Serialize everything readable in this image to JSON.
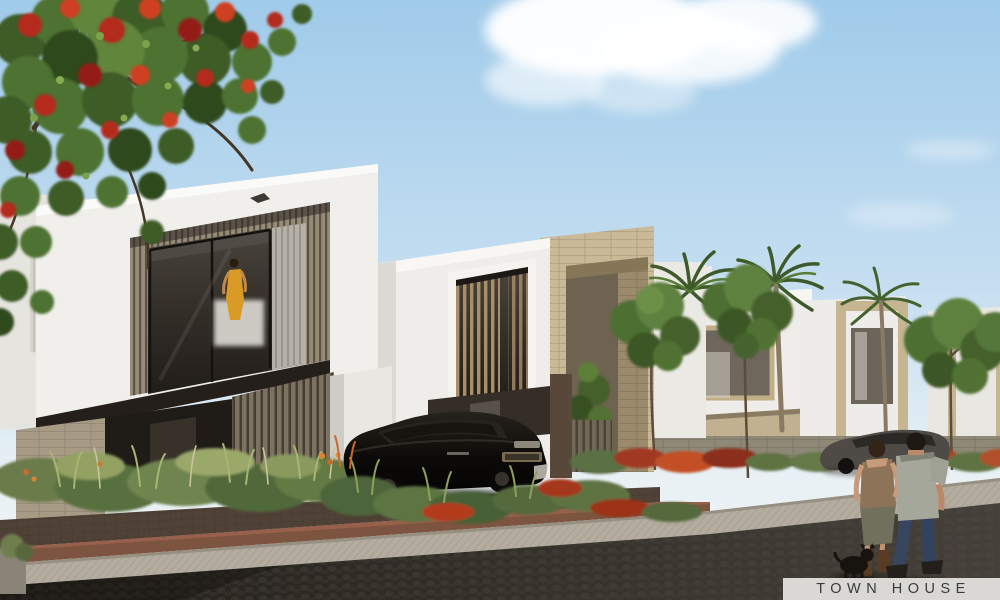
{
  "image": {
    "type": "architectural-render",
    "subject": "Modern two-storey townhouses along a landscaped paved street",
    "caption": {
      "label": "TOWN HOUSE"
    },
    "palette": {
      "sky_top": "#a5cdeb",
      "sky_horizon": "#e9f1f5",
      "cloud": "#ffffff",
      "wall_white": "#efeeea",
      "stone_beige": "#c9b996",
      "wood_slat": "#968b78",
      "glass_dark": "#34302b",
      "foliage_green": "#4e7230",
      "flame_tree_red": "#bf3a20",
      "palm_green": "#3e5a2b",
      "suv_black": "#15120f",
      "sedan_gray": "#4e4b46",
      "driveway_brown": "#4f4136",
      "paver_red": "#7c543f",
      "sidewalk_gray": "#b3ac9f",
      "road_dark": "#2a2621",
      "caption_bg": "#d9d8d5",
      "caption_text": "#3a3a3a"
    }
  }
}
